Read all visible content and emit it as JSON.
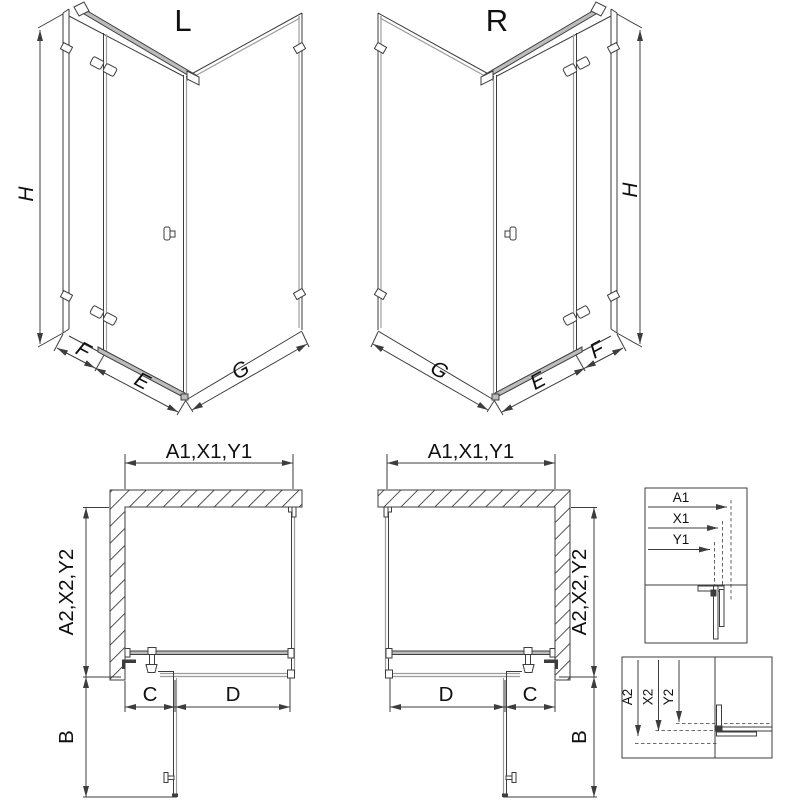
{
  "colors": {
    "background": "#ffffff",
    "line": "#3d3d3d",
    "light_line": "#9c9c9c",
    "hardware_fill": "#bcbcbc",
    "text": "#101010"
  },
  "iso_left": {
    "label": "L",
    "height": "H",
    "panel_f": "F",
    "door_e": "E",
    "side_g": "G"
  },
  "iso_right": {
    "label": "R",
    "height": "H",
    "panel_f": "F",
    "door_e": "E",
    "side_g": "G"
  },
  "plan_left": {
    "width": "A1,X1,Y1",
    "depth": "A2,X2,Y2",
    "seg_c": "C",
    "seg_d": "D",
    "door_b": "B"
  },
  "plan_right": {
    "width": "A1,X1,Y1",
    "depth": "A2,X2,Y2",
    "seg_c": "C",
    "seg_d": "D",
    "door_b": "B"
  },
  "detail_width": {
    "a1": "A1",
    "x1": "X1",
    "y1": "Y1"
  },
  "detail_depth": {
    "a2": "A2",
    "x2": "X2",
    "y2": "Y2"
  }
}
